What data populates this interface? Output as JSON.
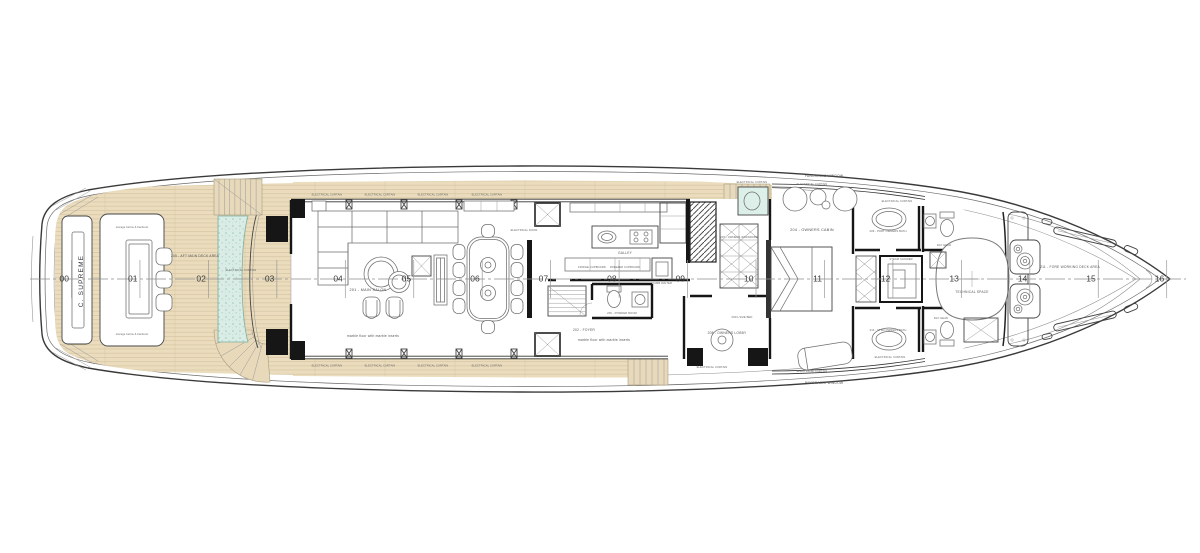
{
  "yacht_name": "C. SUPREME",
  "stations": [
    "00",
    "01",
    "02",
    "03",
    "04",
    "05",
    "06",
    "07",
    "08",
    "09",
    "10",
    "11",
    "12",
    "13",
    "14",
    "15",
    "16"
  ],
  "labels": {
    "aft_deck": "205 - AFT MAIN DECK AREA",
    "storage_below": "storage below & backrest",
    "electrical_curtain": "ELECTRICAL CURTAIN",
    "electrical_door": "ELECTRICAL DOOR",
    "main_salon": "201 - MAIN SALON",
    "marble_floor": "marble floor with marble inserts",
    "galley": "GALLEY",
    "fridge": "FRIDGE CUPBOARD",
    "freezer": "FREEZER CUPBOARD",
    "dumb_waiter": "DUMB WAITER",
    "powder_room": "206 - POWDER ROOM",
    "foyer": "202 - FOYER",
    "owners_wardrobe": "207 - OWNERS WARDROBE",
    "owners_cabin": "204 - OWNERS CABIN",
    "owners_lobby": "208 - OWNERS LOBBY",
    "king_bed": "KING SIZE BED",
    "panoramic_window": "PANORAMIC WINDOW",
    "port_bath": "209 - PORT OWNERS BATH",
    "stbd_bath": "210 - STBD OWNERS BATH",
    "steam_shower": "STEAM SHOWER",
    "day_head": "DAY HEAD",
    "technical_space": "TECHNICAL SPACE",
    "fore_deck": "211 - FORE WORKING DECK AREA"
  },
  "colors": {
    "teak": "#eadcbd",
    "teak_line": "#d3c29c",
    "pool": "#d9ece5",
    "wall": "#161616",
    "line": "#555555"
  }
}
